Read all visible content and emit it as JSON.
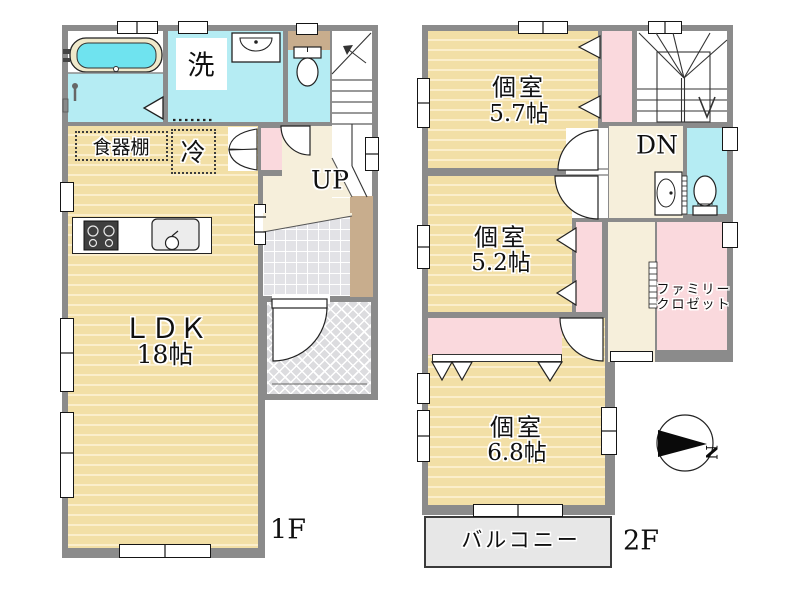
{
  "floor1": {
    "label": "1F",
    "ldk": {
      "name": "ＬＤＫ",
      "size": "18帖"
    },
    "laundry_label": "洗",
    "cupboard_label": "食器棚",
    "fridge_label": "冷",
    "stairs_label": "UP"
  },
  "floor2": {
    "label": "2F",
    "room_57": {
      "name": "個室",
      "size": "5.7帖"
    },
    "room_52": {
      "name": "個室",
      "size": "5.2帖"
    },
    "room_68": {
      "name": "個室",
      "size": "6.8帖"
    },
    "family_closet": {
      "line1": "ファミリー",
      "line2": "クロゼット"
    },
    "balcony_label": "バルコニー",
    "stairs_label": "DN",
    "compass_north": "N"
  },
  "colors": {
    "wall": "#8b8b8b",
    "wood_floor": "#f2dfa6",
    "wood_stripe": "#fbeecb",
    "wet_room": "#b5ecf3",
    "tub_water": "#6fe3ef",
    "hall": "#f6efdb",
    "closet_pink": "#fad9dd",
    "cabinet_brown": "#c8ad8d",
    "entry_tile": "#e2e2e6",
    "porch": "#dcdcdf",
    "balcony": "#e7e7e7"
  }
}
